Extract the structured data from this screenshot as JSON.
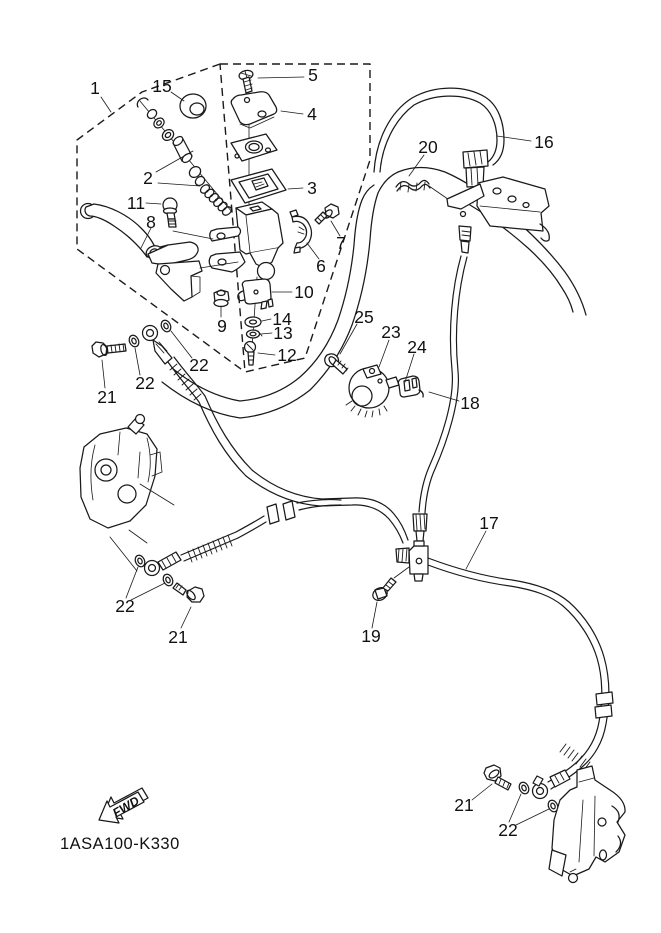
{
  "drawing": {
    "part_code": "1ASA100-K330",
    "fwd_label": "FWD"
  },
  "colors": {
    "ink": "#1a1a1a",
    "background": "#ffffff"
  },
  "callouts": [
    {
      "text": "1",
      "x": 95,
      "y": 88
    },
    {
      "text": "15",
      "x": 162,
      "y": 86
    },
    {
      "text": "5",
      "x": 313,
      "y": 75
    },
    {
      "text": "4",
      "x": 312,
      "y": 114
    },
    {
      "text": "2",
      "x": 148,
      "y": 178
    },
    {
      "text": "3",
      "x": 312,
      "y": 188
    },
    {
      "text": "11",
      "x": 136,
      "y": 203
    },
    {
      "text": "8",
      "x": 151,
      "y": 222
    },
    {
      "text": "7",
      "x": 341,
      "y": 243
    },
    {
      "text": "6",
      "x": 321,
      "y": 266
    },
    {
      "text": "10",
      "x": 304,
      "y": 292
    },
    {
      "text": "9",
      "x": 222,
      "y": 326
    },
    {
      "text": "14",
      "x": 282,
      "y": 319
    },
    {
      "text": "13",
      "x": 283,
      "y": 333
    },
    {
      "text": "12",
      "x": 287,
      "y": 355
    },
    {
      "text": "22",
      "x": 199,
      "y": 365
    },
    {
      "text": "22",
      "x": 145,
      "y": 383
    },
    {
      "text": "21",
      "x": 107,
      "y": 397
    },
    {
      "text": "25",
      "x": 364,
      "y": 317
    },
    {
      "text": "23",
      "x": 391,
      "y": 332
    },
    {
      "text": "24",
      "x": 417,
      "y": 347
    },
    {
      "text": "16",
      "x": 544,
      "y": 142
    },
    {
      "text": "20",
      "x": 428,
      "y": 147
    },
    {
      "text": "18",
      "x": 470,
      "y": 403
    },
    {
      "text": "17",
      "x": 489,
      "y": 523
    },
    {
      "text": "19",
      "x": 371,
      "y": 636
    },
    {
      "text": "21",
      "x": 178,
      "y": 637
    },
    {
      "text": "22",
      "x": 125,
      "y": 606
    },
    {
      "text": "21",
      "x": 464,
      "y": 805
    },
    {
      "text": "22",
      "x": 508,
      "y": 830
    }
  ]
}
